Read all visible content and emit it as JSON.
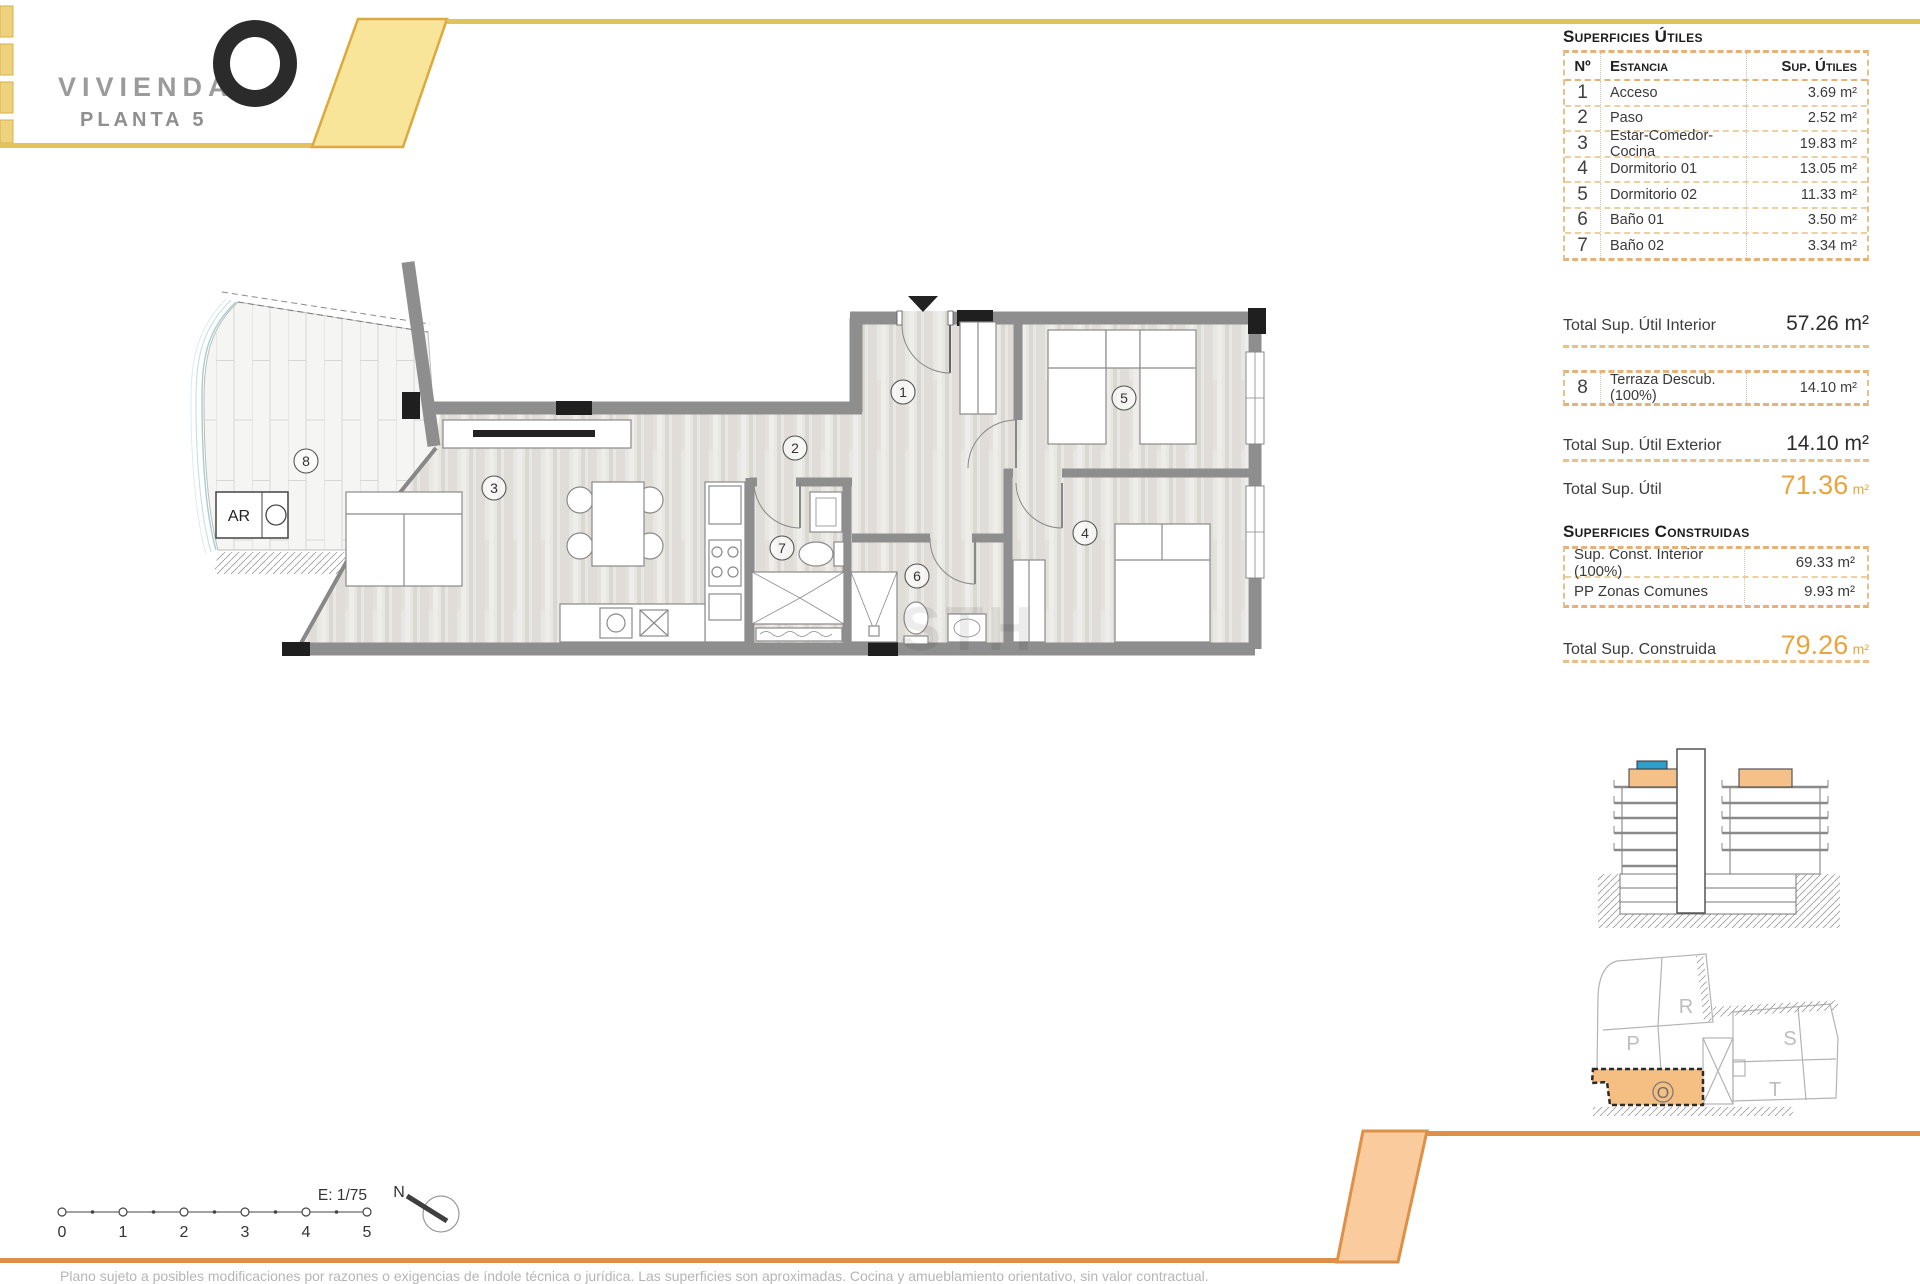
{
  "header": {
    "brand": "VIVIENDA",
    "floor": "PLANTA 5"
  },
  "surfaces": {
    "title": "Superficies Útiles",
    "col_n": "Nº",
    "col_room": "Estancia",
    "col_sup": "Sup. Útiles",
    "rows": [
      {
        "n": "1",
        "room": "Acceso",
        "sup": "3.69 m²"
      },
      {
        "n": "2",
        "room": "Paso",
        "sup": "2.52 m²"
      },
      {
        "n": "3",
        "room": "Estar-Comedor-Cocina",
        "sup": "19.83 m²"
      },
      {
        "n": "4",
        "room": "Dormitorio 01",
        "sup": "13.05 m²"
      },
      {
        "n": "5",
        "room": "Dormitorio 02",
        "sup": "11.33 m²"
      },
      {
        "n": "6",
        "room": "Baño 01",
        "sup": "3.50 m²"
      },
      {
        "n": "7",
        "room": "Baño 02",
        "sup": "3.34 m²"
      }
    ],
    "total_interior_label": "Total Sup. Útil Interior",
    "total_interior_value": "57.26 m²",
    "row8": {
      "n": "8",
      "room": "Terraza Descub.(100%)",
      "sup": "14.10 m²"
    },
    "total_exterior_label": "Total Sup. Útil Exterior",
    "total_exterior_value": "14.10 m²",
    "total_label": "Total Sup. Útil",
    "total_value": "71.36",
    "total_unit": "m²"
  },
  "built": {
    "title": "Superficies Construidas",
    "rows": [
      {
        "room": "Sup. Const. Interior (100%)",
        "sup": "69.33 m²"
      },
      {
        "room": "PP Zonas Comunes",
        "sup": "9.93 m²"
      }
    ],
    "total_label": "Total Sup. Construida",
    "total_value": "79.26",
    "total_unit": "m²"
  },
  "floorplan": {
    "labels": {
      "r1": "1",
      "r2": "2",
      "r3": "3",
      "r4": "4",
      "r5": "5",
      "r6": "6",
      "r7": "7",
      "r8": "8"
    },
    "ar_label": "AR",
    "watermark": "STH"
  },
  "scalebar": {
    "ticks": [
      "0",
      "1",
      "2",
      "3",
      "4",
      "5"
    ],
    "scale": "E: 1/75",
    "north": "N"
  },
  "sitemap": {
    "blocks": [
      "R",
      "P",
      "S",
      "T"
    ],
    "unit": "O"
  },
  "colors": {
    "accent_yellow": "#e3c25e",
    "accent_orange": "#de9049",
    "total_orange": "#e9a43f"
  },
  "disclaimer": "Plano sujeto a posibles modificaciones por razones o exigencias de índole técnica o jurídica. Las superficies son aproximadas. Cocina y amueblamiento orientativo, sin valor contractual."
}
